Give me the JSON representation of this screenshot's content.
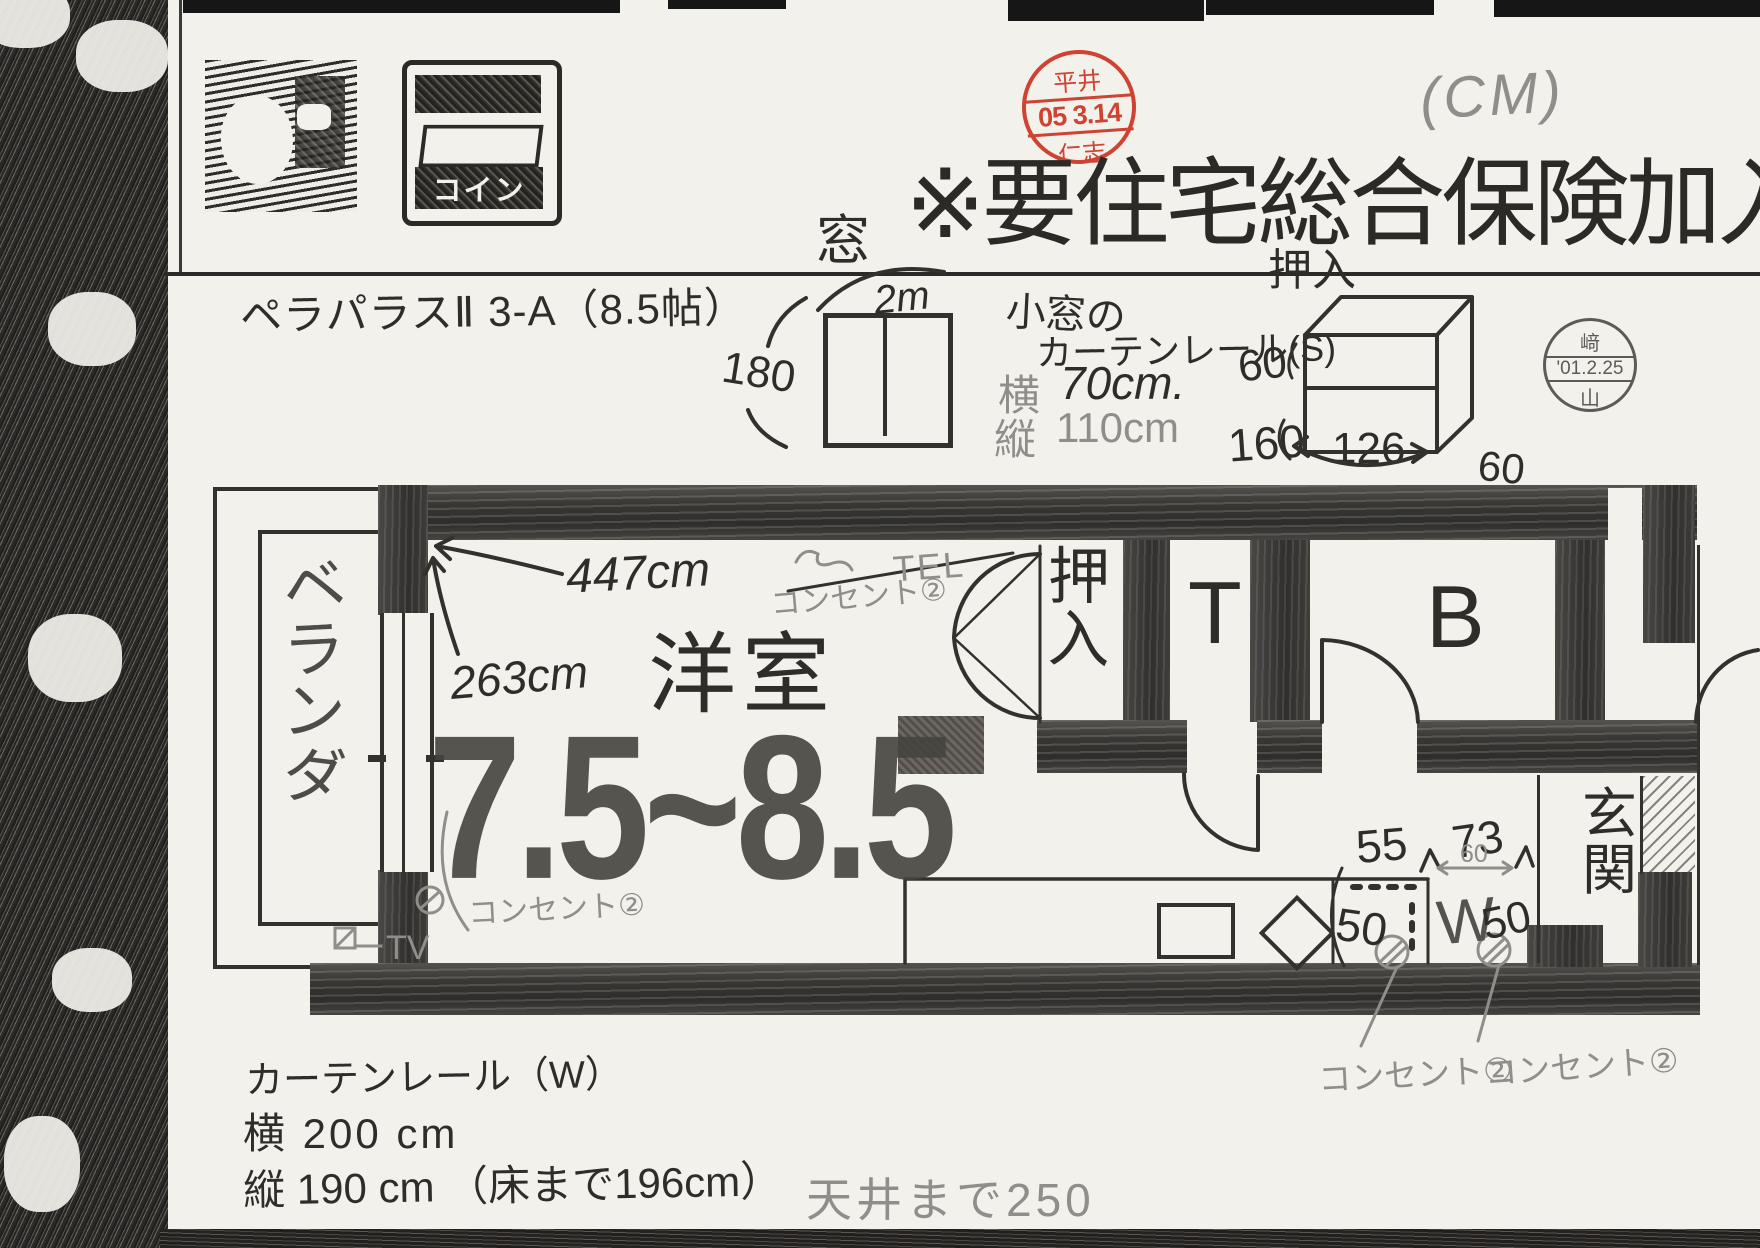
{
  "colors": {
    "pen": "#2f2d2a",
    "pencil": "#8f8e8a",
    "stamp_red": "#cd3a28",
    "wall": "#383734",
    "paper": "#f3f1eb"
  },
  "header": {
    "paren_note": "(CM)",
    "red_stamp": {
      "top": "平井",
      "date": "05 3.14",
      "bottom": "仁志"
    },
    "title": "※要住宅総合保険加入",
    "property": "ペラパラスⅡ 3-A（8.5帖）"
  },
  "icon2_text": "コイン",
  "window_sketch": {
    "label": "窓",
    "w": "2m",
    "h": "180"
  },
  "small_window": {
    "l1": "小窓の",
    "l2": "カーテンレール(S)",
    "w_key": "横",
    "w_val": "70cm.",
    "h_key": "縦",
    "h_val": "110cm"
  },
  "closet_sketch": {
    "label": "押入",
    "d_top": "60",
    "d_left": "160",
    "d_front": "126",
    "d_right": "60"
  },
  "date_stamp": {
    "top": "﨑",
    "date": "'01.2.25",
    "bottom": "山"
  },
  "plan": {
    "veranda_chars": [
      "ベ",
      "ラ",
      "ン",
      "ダ"
    ],
    "width": "447cm",
    "depth": "263cm",
    "outlet_note": "コンセント②",
    "tel": "TEL",
    "room": "洋室",
    "size": "7.5~8.5",
    "closet_chars": [
      "押",
      "入"
    ],
    "toilet": "T",
    "bath": "B",
    "entrance_chars": [
      "玄",
      "関"
    ],
    "washer": "W",
    "d55": "55",
    "d73": "73",
    "d60": "60",
    "d50a": "50",
    "d50b": "50",
    "outlet_left": "コンセント②",
    "tv": "ーTV",
    "outlet_b1": "コンセント②",
    "outlet_b2": "コンセント②"
  },
  "footer": {
    "rail": "カーテンレール（W）",
    "rail_w": "横 200 cm",
    "rail_h": "縦 190 cm （床まで196cm）",
    "ceiling": "天井まで250"
  }
}
